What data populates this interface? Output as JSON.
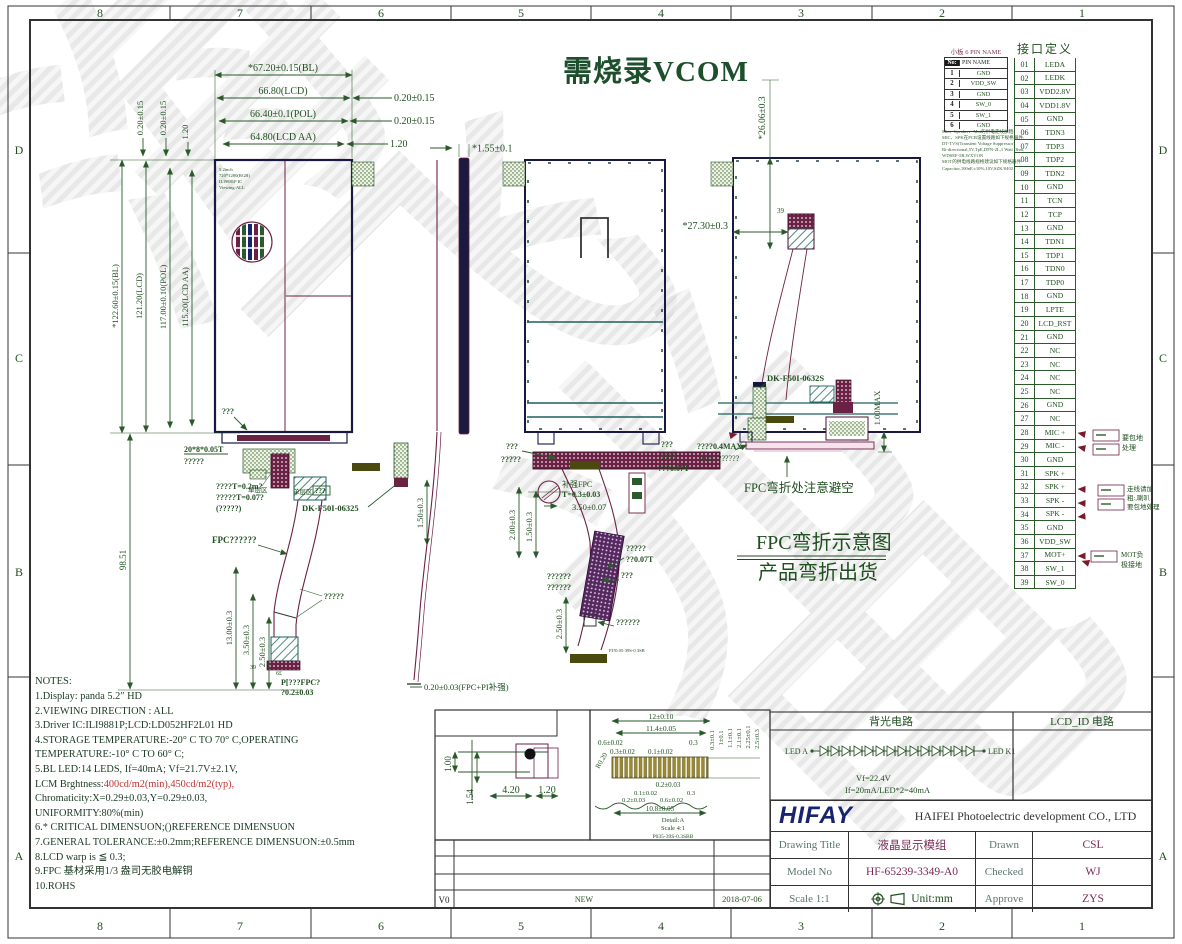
{
  "sheet": {
    "zones_h": [
      "8",
      "7",
      "6",
      "5",
      "4",
      "3",
      "2",
      "1"
    ],
    "zones_v": [
      "D",
      "C",
      "B",
      "A"
    ],
    "watermark_chars": [
      "海",
      "飞",
      "光",
      "电"
    ]
  },
  "header_title": "需烧录VCOM",
  "small_board": {
    "title": "小板 6 PIN NAME",
    "col_no": "No:",
    "col_name": "PIN NAME",
    "rows": [
      {
        "no": "1",
        "name": "GND"
      },
      {
        "no": "2",
        "name": "VDD_SW"
      },
      {
        "no": "3",
        "name": "GND"
      },
      {
        "no": "4",
        "name": "SW_0"
      },
      {
        "no": "5",
        "name": "SW_1"
      },
      {
        "no": "6",
        "name": "GND"
      }
    ]
  },
  "tiny_notes": {
    "lines": [
      {
        "text": "Mic、Speaker、Mot的供电走线加粗:"
      },
      {
        "text": "MIC、SPK在PCB设置线路如下规格器件:"
      },
      {
        "text": "DT-TVS(Transient Voltage Suppressor)"
      },
      {
        "text": "Bi-directional,5V,TpE,DFN-2L,1 Watt Ohm,"
      },
      {
        "text": "WDSEF-5R,WXVON"
      },
      {
        "text": "MOT的供电线路规格建议如下规格器件:"
      },
      {
        "text": "Capacitor,100nF,±10%,10V,SZK/0402"
      }
    ]
  },
  "pin_table": {
    "title": "接口定义",
    "rows": [
      {
        "no": "01",
        "name": "LEDA"
      },
      {
        "no": "02",
        "name": "LEDK"
      },
      {
        "no": "03",
        "name": "VDD2.8V"
      },
      {
        "no": "04",
        "name": "VDD1.8V"
      },
      {
        "no": "05",
        "name": "GND"
      },
      {
        "no": "06",
        "name": "TDN3"
      },
      {
        "no": "07",
        "name": "TDP3"
      },
      {
        "no": "08",
        "name": "TDP2"
      },
      {
        "no": "09",
        "name": "TDN2"
      },
      {
        "no": "10",
        "name": "GND"
      },
      {
        "no": "11",
        "name": "TCN"
      },
      {
        "no": "12",
        "name": "TCP"
      },
      {
        "no": "13",
        "name": "GND"
      },
      {
        "no": "14",
        "name": "TDN1"
      },
      {
        "no": "15",
        "name": "TDP1"
      },
      {
        "no": "16",
        "name": "TDN0"
      },
      {
        "no": "17",
        "name": "TDP0"
      },
      {
        "no": "18",
        "name": "GND"
      },
      {
        "no": "19",
        "name": "LPTE"
      },
      {
        "no": "20",
        "name": "LCD_RST"
      },
      {
        "no": "21",
        "name": "GND"
      },
      {
        "no": "22",
        "name": "NC"
      },
      {
        "no": "23",
        "name": "NC"
      },
      {
        "no": "24",
        "name": "NC"
      },
      {
        "no": "25",
        "name": "NC"
      },
      {
        "no": "26",
        "name": "GND"
      },
      {
        "no": "27",
        "name": "NC"
      },
      {
        "no": "28",
        "name": "MIC +"
      },
      {
        "no": "29",
        "name": "MIC -"
      },
      {
        "no": "30",
        "name": "GND"
      },
      {
        "no": "31",
        "name": "SPK +"
      },
      {
        "no": "32",
        "name": "SPK +"
      },
      {
        "no": "33",
        "name": "SPK -"
      },
      {
        "no": "34",
        "name": "SPK -"
      },
      {
        "no": "35",
        "name": "GND"
      },
      {
        "no": "36",
        "name": "VDD_SW"
      },
      {
        "no": "37",
        "name": "MOT+"
      },
      {
        "no": "38",
        "name": "SW_1"
      },
      {
        "no": "39",
        "name": "SW_0"
      }
    ],
    "ann_mic1": "要包地",
    "ann_mic2": "处理",
    "ann_spk1": "走线请加",
    "ann_spk2": "粗:,喇叭",
    "ann_spk3": "要包地处理",
    "ann_mot1": "MOT负",
    "ann_mot2": "极接地"
  },
  "views": {
    "front": {
      "top_dims": [
        "*67.20±0.15(BL)",
        "66.80(LCD)",
        "66.40±0.1(POL)",
        "64.80(LCD AA)"
      ],
      "right_dims": [
        "0.20±0.15",
        "0.20±0.15",
        "1.20"
      ],
      "top_left_dims": [
        "0.20±0.15",
        "0.20±0.15",
        "1.20"
      ],
      "left_dims": [
        "*122.60±0.15(BL)",
        "121.20(LCD)",
        "117.00±0.10(POL)",
        "115.20(LCD AA)"
      ],
      "screen_info": [
        "5.2inch",
        "720*1280(RGB)",
        "ILI9881P IC",
        "Viewing:ALL"
      ],
      "dim_height_fpc": "98.51",
      "dim_13": "13.00±0.3",
      "dim_35": "3.50±0.3",
      "dim_25": "2.50±0.3",
      "dim_15": "1.50±0.3",
      "lbl_q3": "???",
      "lbl_tape": "20*8*0.05T",
      "lbl_tape2": "?????",
      "lbl_single1": "单层区",
      "lbl_single2": "单层区",
      "lbl_single2b": "???",
      "lbl_t02": "????T=0.2m?",
      "lbl_t007": "?????T=0.07?",
      "lbl_paren": "(?????)",
      "lbl_dk": "DK-F50I-06325",
      "lbl_fpc": "FPC??????",
      "lbl_fold": "?????",
      "end_39": "39",
      "end_6e": "6£",
      "end_pi": "P[???FPC?",
      "end_tol": "?0.2±0.03"
    },
    "side": {
      "dim_t": "*1.55±0.1",
      "note": "0.20±0.03(FPC+PI补强)"
    },
    "rear": {
      "lbl_q3": "???",
      "lbl_q5": "?????",
      "stiff": "补强FPC",
      "stiff_t": "T=0.3±0.03",
      "dim_35": "3.50±0.07",
      "dim_2": "2.00±0.3",
      "dim_15": "1.50±0.3",
      "lbl_q5b": "?????",
      "lbl_007": "??0.07T",
      "lbl_q6a": "??????",
      "lbl_q6b": "??????",
      "lbl_q3b": "???",
      "dim_25": "2.50±0.3",
      "lbl_q6c": "??????",
      "tiny": "PI?0.05-39S-0.3SB"
    },
    "bent": {
      "dim_26": "*26.06±0.3",
      "dim_27": "*27.30±0.3",
      "pin39": "39",
      "lbl_dk": "DK-F50I-0632S",
      "dim_1max": "1.00MAX",
      "lbl_04max": "????0.4MAX",
      "lbl_005t": "0.05T??????",
      "lbl_q3": "???",
      "lbl_q4": "????",
      "lbl_007": "???0.07T",
      "avoid": "FPC弯折处注意避空"
    }
  },
  "bend_title": {
    "line1": "FPC弯折示意图",
    "line2": "产品弯折出货"
  },
  "notes": {
    "heading": "NOTES:",
    "lines": [
      {
        "text": "1.Display: panda 5.2″ HD",
        "red": ""
      },
      {
        "text": "2.VIEWING DIRECTION : ALL",
        "red": ""
      },
      {
        "text": "3.Driver IC:ILI9881P;LCD:LD052HF2L01 HD",
        "red": ""
      },
      {
        "text": "4.STORAGE TEMPERATURE:-20° C TO 70° C,OPERATING",
        "red": ""
      },
      {
        "text": " TEMPERATURE:-10° C TO 60° C;",
        "red": ""
      },
      {
        "text": "5.BL LED:14 LEDS,  If=40mA; Vf=21.7V±2.1V,",
        "red": ""
      },
      {
        "text": "LCM Brghtness:",
        "red": "400cd/m2(min),450cd/m2(typ),"
      },
      {
        "text": "Chromaticity:X=0.29±0.03,Y=0.29±0.03,",
        "red": ""
      },
      {
        "text": "UNIFORMITY:80%(min)",
        "red": ""
      },
      {
        "text": "6.* CRITICAL DIMENSUON;()REFERENCE DIMENSUON",
        "red": ""
      },
      {
        "text": "7.GENERAL TOLERANCE:±0.2mm;REFERENCE DIMENSUON:±0.5mm",
        "red": ""
      },
      {
        "text": "8.LCD warp is ≦ 0.3;",
        "red": ""
      },
      {
        "text": "9.FPC 基材采用1/3 盎司无胶电解铜",
        "red": ""
      },
      {
        "text": "10.ROHS",
        "red": ""
      }
    ]
  },
  "silver": {
    "title": "银浆位置放大图",
    "d1": "1.00",
    "d2": "1.54",
    "d3": "4.20",
    "d4": "1.20"
  },
  "detail": {
    "t1": "12±0.10",
    "t2": "11.4±0.05",
    "t3": "0.6±0.02",
    "t4": "0.3±0.02",
    "t5": "0.1±0.02",
    "t6": "0.3",
    "r1": "0.3±0.1",
    "r2": "1±0.1",
    "r3": "1.1±0.1",
    "r4": "2.1±0.1",
    "r5": "2.25±0.1",
    "r6": "2.5±0.3",
    "b1": "0.2±0.03",
    "b2": "0.1±0.02",
    "b3": "0.3",
    "b4": "0.2±0.03",
    "b5": "0.6±0.02",
    "b6": "10.8±0.05",
    "c1": "Detail:A",
    "c2": "Scale 4:1",
    "c3": "P035-39S-0.3SBB",
    "radius": "R0.20"
  },
  "backlight": {
    "title": "背光电路",
    "led_a": "LED A",
    "led_k": "LED K1",
    "vf": "Vf=22.4V",
    "if_line": "If=20mA/LED*2=40mA"
  },
  "lcd_id": {
    "title": "LCD_ID 电路"
  },
  "title_block": {
    "logo": "HIFAY",
    "company": "HAIFEI Photoelectric development CO., LTD",
    "r1_label": "Drawing Title",
    "r1_value": "液晶显示模组",
    "r1_label2": "Drawn",
    "r1_value2": "CSL",
    "r2_label": "Model No",
    "r2_value": "HF-65239-3349-A0",
    "r2_label2": "Checked",
    "r2_value2": "WJ",
    "r3_label": "Scale 1:1",
    "r3_unit": "Unit:mm",
    "r3_label2": "Approve",
    "r3_value2": "ZYS"
  },
  "revision": {
    "rev": "V0",
    "desc": "NEW",
    "date": "2018-07-06"
  }
}
